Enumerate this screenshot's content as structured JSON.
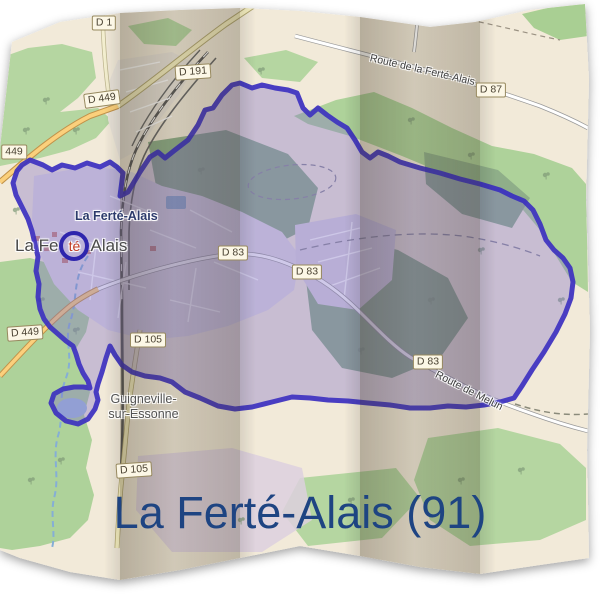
{
  "title": {
    "text": "La Ferté-Alais (91)",
    "color": "#1e4482"
  },
  "map": {
    "colors": {
      "paper": "#f2ead9",
      "forest_green": "#b5d6a1",
      "urban_gray": "#dfdae2",
      "water_blue": "#9dbbdc",
      "road_orange": "#fbd07c",
      "road_pale": "#f6efc0",
      "boundary_stroke": "#3b2fc0",
      "boundary_fill": "rgba(127,112,199,0.40)",
      "fold_shade": "rgba(70,58,38,0.24)",
      "marker_ring": "#2e25ad",
      "marker_highlight": "#c23b22"
    },
    "labels": {
      "town_bold": "La Ferté-Alais",
      "town_big": {
        "pre": "La Fe",
        "highlight": "té",
        "post": "Alais"
      },
      "village_line1": "Guigneville-",
      "village_line2": "sur-Essonne",
      "route_north": "Route de la Ferté-Alais",
      "route_south": "Route de Melun",
      "refs": [
        {
          "text": "D 1"
        },
        {
          "text": "D 191"
        },
        {
          "text": "D 449"
        },
        {
          "text": "449"
        },
        {
          "text": "D 87"
        },
        {
          "text": "D 83"
        },
        {
          "text": "D 83"
        },
        {
          "text": "D 83"
        },
        {
          "text": "D 105"
        },
        {
          "text": "D 449"
        },
        {
          "text": "D 105"
        }
      ]
    }
  }
}
